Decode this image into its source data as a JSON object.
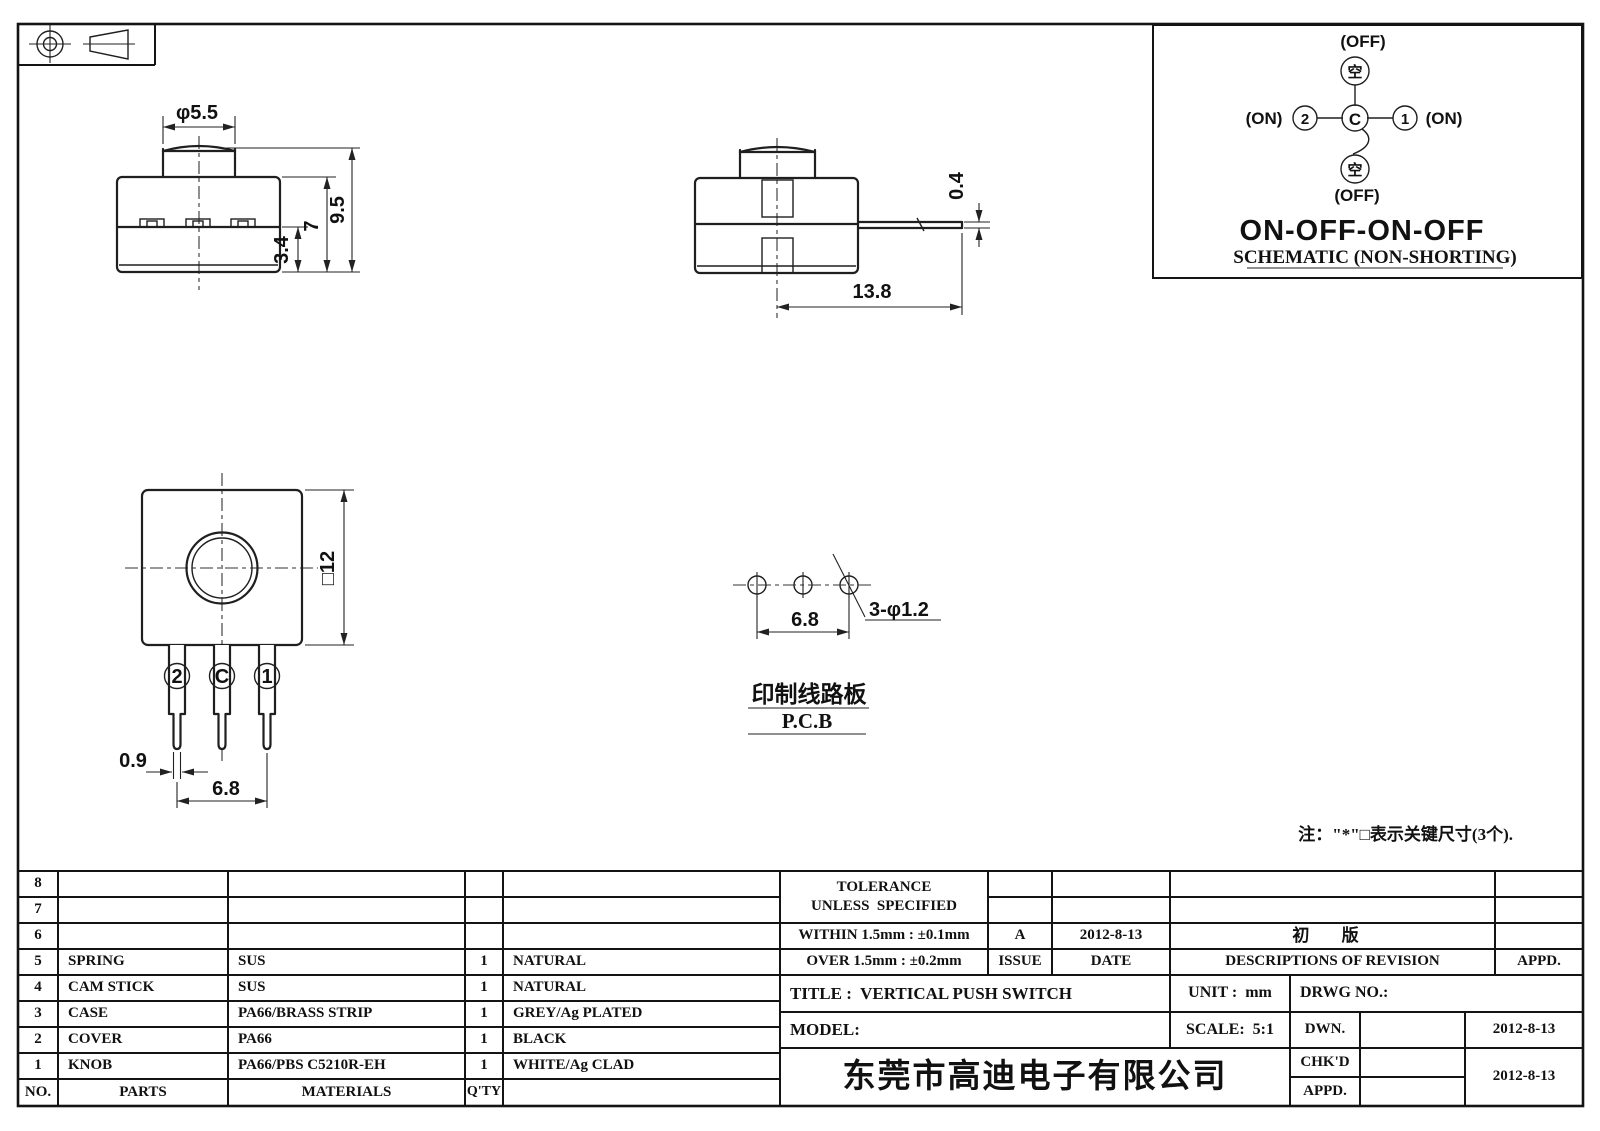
{
  "drawing": {
    "front_view": {
      "dia_label": "φ5.5",
      "height_total": "9.5",
      "height_body": "7",
      "height_base": "3.4"
    },
    "side_view": {
      "terminal_thickness": "0.4",
      "terminal_length": "13.8"
    },
    "bottom_view": {
      "square_size": "□12",
      "pin_width": "0.9",
      "pin_pitch": "6.8",
      "pin_labels": [
        "2",
        "C",
        "1"
      ]
    },
    "pcb_view": {
      "hole_pitch": "6.8",
      "hole_spec": "3-φ1.2",
      "label_cn": "印制线路板",
      "label_en": "P.C.B"
    },
    "note": "注：\"*\"□表示关键尺寸(3个)."
  },
  "schematic": {
    "states": {
      "top": "(OFF)",
      "bottom": "(OFF)",
      "left": "(ON)",
      "right": "(ON)"
    },
    "terminals": {
      "top": "空",
      "bottom": "空",
      "left": "2",
      "right": "1",
      "common": "C"
    },
    "function": "ON-OFF-ON-OFF",
    "caption": "SCHEMATIC (NON-SHORTING)"
  },
  "parts_table": {
    "headers": {
      "no": "NO.",
      "parts": "PARTS",
      "materials": "MATERIALS",
      "qty": "Q'TY"
    },
    "rows": [
      {
        "no": "8",
        "part": "",
        "material": "",
        "qty": "",
        "color": ""
      },
      {
        "no": "7",
        "part": "",
        "material": "",
        "qty": "",
        "color": ""
      },
      {
        "no": "6",
        "part": "",
        "material": "",
        "qty": "",
        "color": ""
      },
      {
        "no": "5",
        "part": "SPRING",
        "material": "SUS",
        "qty": "1",
        "color": "NATURAL"
      },
      {
        "no": "4",
        "part": "CAM STICK",
        "material": "SUS",
        "qty": "1",
        "color": "NATURAL"
      },
      {
        "no": "3",
        "part": "CASE",
        "material": "PA66/BRASS STRIP",
        "qty": "1",
        "color": "GREY/Ag PLATED"
      },
      {
        "no": "2",
        "part": "COVER",
        "material": "PA66",
        "qty": "1",
        "color": "BLACK"
      },
      {
        "no": "1",
        "part": "KNOB",
        "material": "PA66/PBS C5210R-EH",
        "qty": "1",
        "color": "WHITE/Ag CLAD"
      }
    ]
  },
  "title_block": {
    "tolerance_line1": "TOLERANCE",
    "tolerance_line2": "UNLESS  SPECIFIED",
    "within": "WITHIN 1.5mm : ±0.1mm",
    "over": "OVER 1.5mm : ±0.2mm",
    "issue_value": "A",
    "issue_label": "ISSUE",
    "date_value": "2012-8-13",
    "date_label": "DATE",
    "revision_desc": "初 版",
    "revision_label": "DESCRIPTIONS OF REVISION",
    "appd_label": "APPD.",
    "title": "TITLE :  VERTICAL PUSH SWITCH",
    "unit": "UNIT :  mm",
    "drwg_no": "DRWG NO.:",
    "model": "MODEL:",
    "scale": "SCALE:  5:1",
    "dwn_label": "DWN.",
    "dwn_date": "2012-8-13",
    "chkd_label": "CHK'D",
    "chkd_date": "2012-8-13",
    "appd2_label": "APPD.",
    "company": "东莞市高迪电子有限公司"
  }
}
